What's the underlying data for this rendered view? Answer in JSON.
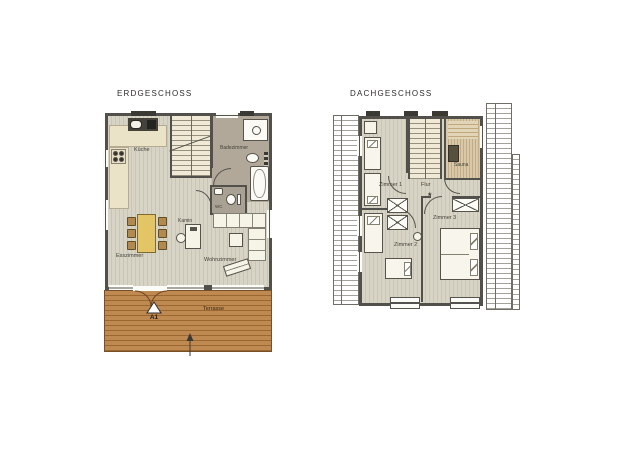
{
  "colors": {
    "wall": "#52504a",
    "floor_base": "#d7d3c5",
    "floor_stripe": "#c9c5b7",
    "bath_floor": "#b1a89a",
    "counter_cream": "#ebe3c8",
    "counter_dark": "#44423a",
    "stairs_fill": "#efe9d6",
    "dining_table": "#e4c566",
    "chair": "#b28a50",
    "terrace_wood": "#bf8952",
    "terrace_stripe": "#9c672f",
    "sauna_wood": "#d9c9ab",
    "door_swing": "#6b4320"
  },
  "erdgeschoss": {
    "title": "ERDGESCHOSS",
    "labels": {
      "kueche": "Küche",
      "badezimmer": "Badezimmer",
      "wc": "WC",
      "kamin": "Kamin",
      "esszimmer": "Esszimmer",
      "wohnzimmer": "Wohnzimmer",
      "terrasse": "Terrasse",
      "entrance_marker": "A1"
    }
  },
  "dachgeschoss": {
    "title": "DACHGESCHOSS",
    "labels": {
      "zimmer1": "Zimmer 1",
      "flur": "Flur",
      "sauna": "Sauna",
      "zimmer2": "Zimmer 2",
      "zimmer3": "Zimmer 3"
    },
    "stair_marker": "*"
  }
}
